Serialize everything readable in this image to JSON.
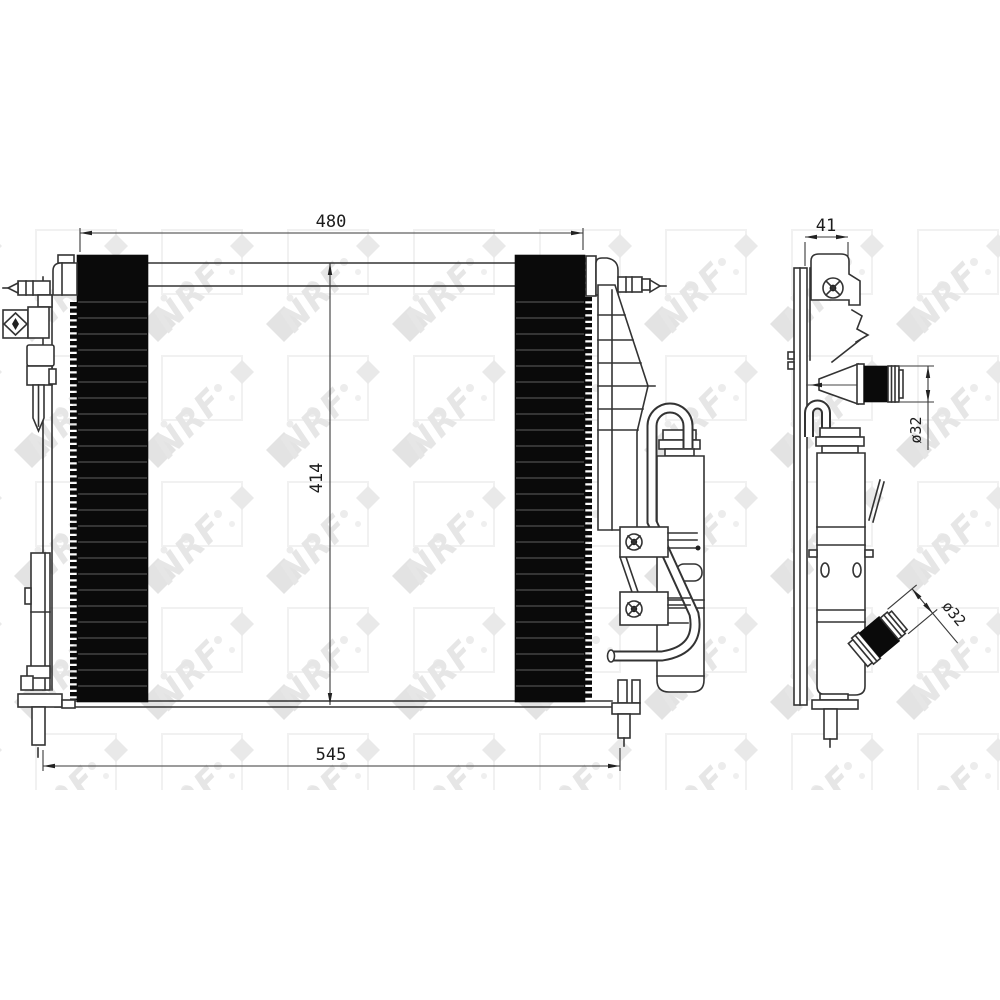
{
  "drawing": {
    "kind": "technical line drawing",
    "subject": "radiator / condenser assembly with receiver drier",
    "background": "#ffffff",
    "line_color": "#333333",
    "core_fill": "#0a0a0a",
    "watermark": {
      "brand": "NRF",
      "color": "#e6e6e6"
    }
  },
  "views": {
    "front": {
      "label": "front view",
      "dimensions": [
        {
          "id": "core-width-top",
          "value": "480"
        },
        {
          "id": "core-height",
          "value": "414"
        },
        {
          "id": "overall-width-bottom",
          "value": "545"
        }
      ]
    },
    "side": {
      "label": "side view",
      "dimensions": [
        {
          "id": "depth",
          "value": "41"
        },
        {
          "id": "upper-port-diameter",
          "value": "ø32"
        },
        {
          "id": "lower-port-diameter",
          "value": "ø32"
        }
      ]
    }
  }
}
